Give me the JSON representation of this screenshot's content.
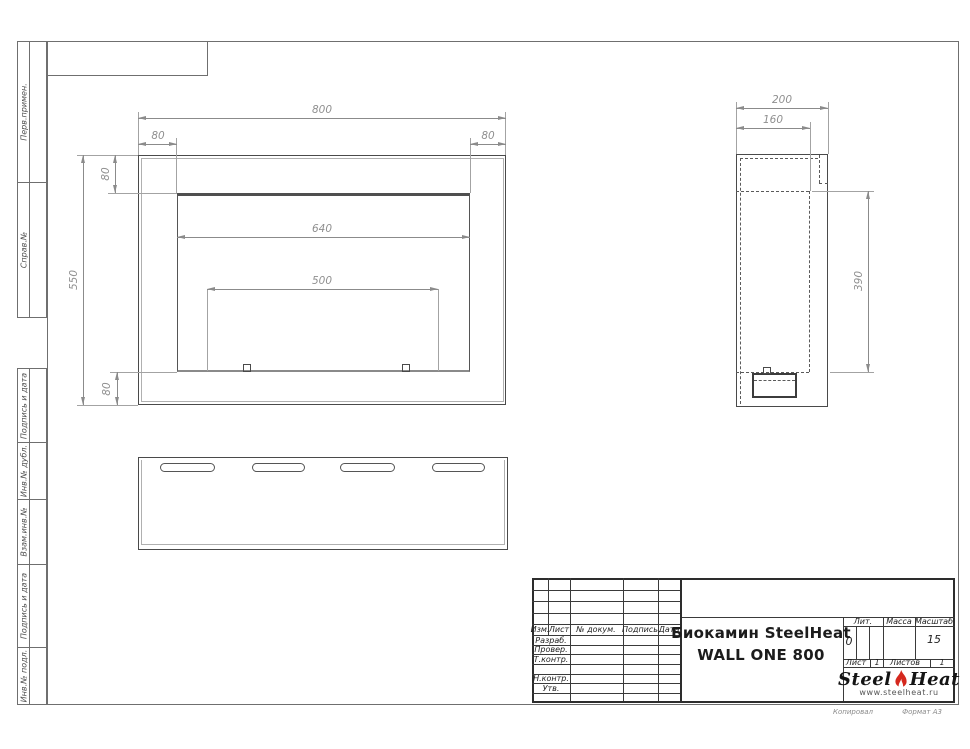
{
  "colors": {
    "outline": "#4a4a4a",
    "dimension": "#8f8f8f",
    "frame": "#6f6f6f",
    "title_block_line": "#2d2d2d",
    "flame_red": "#d5281e"
  },
  "sidebar": {
    "items": [
      {
        "label": "Перв.примен."
      },
      {
        "label": "Справ.№"
      },
      {
        "label": "Подпись и дата"
      },
      {
        "label": "Инв.№ дубл."
      },
      {
        "label": "Взам.инв.№"
      },
      {
        "label": "Подпись и дата"
      },
      {
        "label": "Инв.№ подл."
      }
    ]
  },
  "views": {
    "front": {
      "dims": {
        "width": "800",
        "inset_left": "80",
        "inset_right": "80",
        "inset_top": "80",
        "height": "550",
        "inset_bottom": "80",
        "opening_width": "640",
        "burner_width": "500"
      }
    },
    "side": {
      "dims": {
        "depth": "200",
        "inner_depth": "160",
        "opening_height": "390"
      }
    }
  },
  "title_block": {
    "header_cols": {
      "izm": "Изм.",
      "list": "Лист",
      "doc": "№ докум.",
      "sign": "Подпись",
      "date": "Дата"
    },
    "rows": {
      "razrab": "Разраб.",
      "prover": "Провер.",
      "tkontr": "Т.контр.",
      "nkontr": "Н.контр.",
      "utv": "Утв."
    },
    "name_line1": "Биокамин SteelHeat",
    "name_line2": "WALL ONE 800",
    "lit_label": "Лит.",
    "lit_value": "0",
    "massa_label": "Масса",
    "scale_label": "Масштаб",
    "scale_value": "15",
    "sheet_label": "Лист",
    "sheet_value": "1",
    "sheets_label": "Листов",
    "sheets_value": "1",
    "logo_steel": "Steel",
    "logo_heat": "Heat",
    "logo_url": "www.steelheat.ru",
    "footer_copy": "Копировал",
    "footer_format": "Формат А3"
  }
}
